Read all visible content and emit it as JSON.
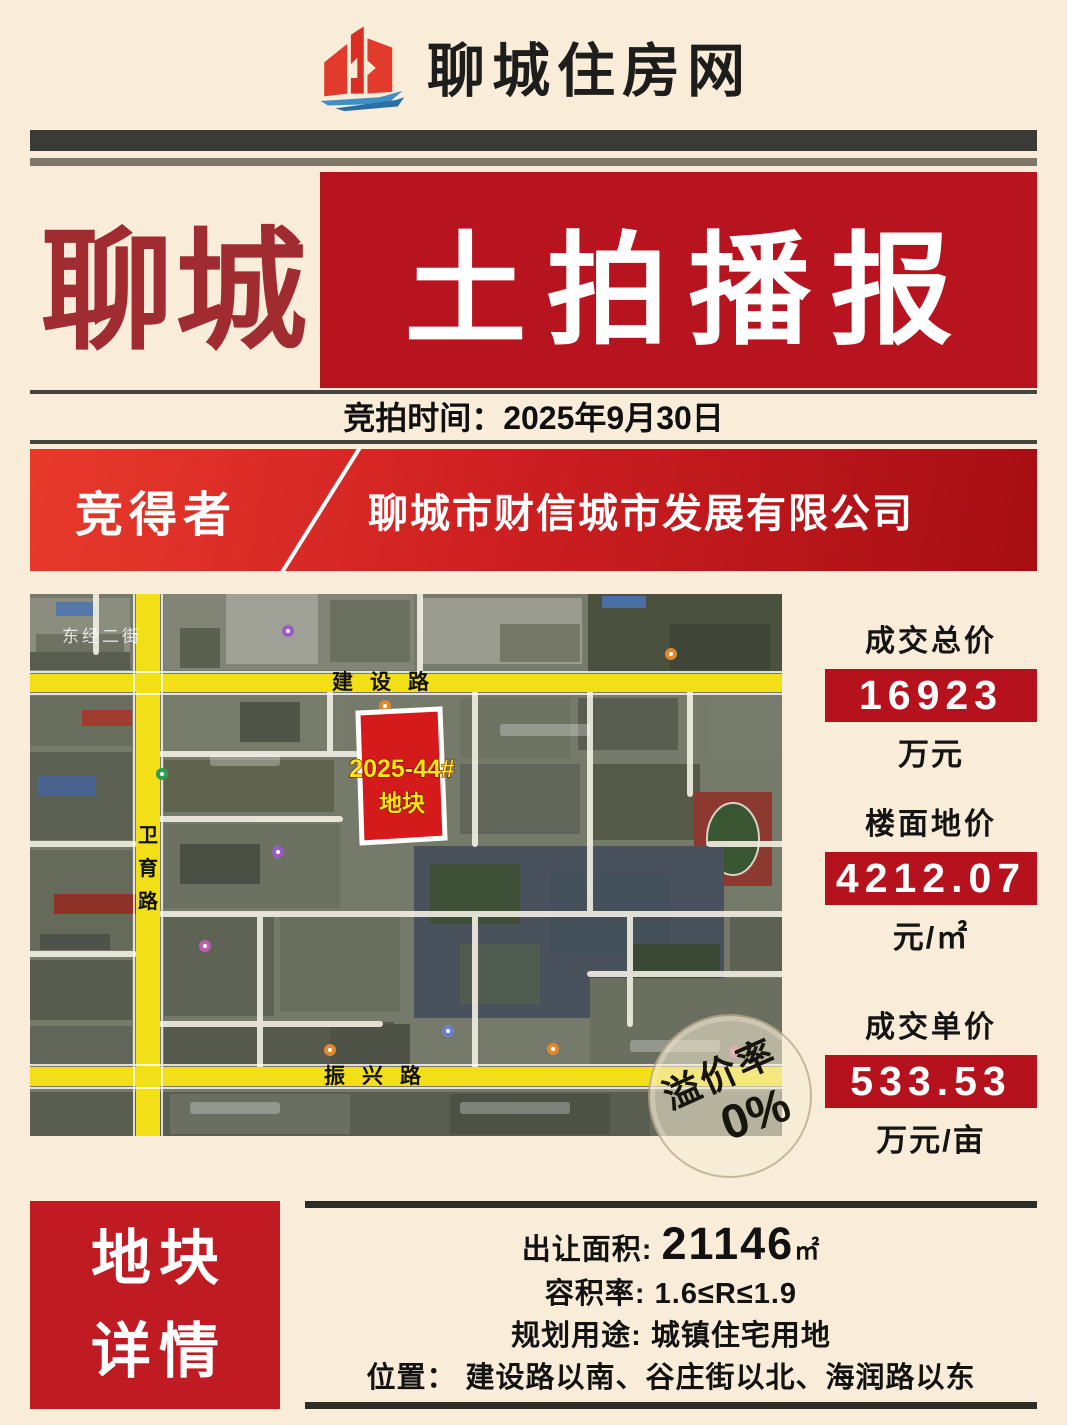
{
  "header": {
    "site_name": "聊城住房网"
  },
  "masthead": {
    "city": "聊城",
    "title": "土拍播报"
  },
  "auction_time": {
    "label": "竞拍时间：",
    "value": "2025年9月30日"
  },
  "winner": {
    "label": "竞得者",
    "company": "聊城市财信城市发展有限公司"
  },
  "map": {
    "road_north": "建设路",
    "road_west_chars": [
      "卫",
      "育",
      "路"
    ],
    "road_south": "振兴路",
    "district_label": "东经二街",
    "parcel": {
      "line1": "2025-44#",
      "line2": "地块"
    },
    "stamp": {
      "label": "溢价率",
      "value": "0%"
    }
  },
  "stats": [
    {
      "label": "成交总价",
      "value": "16923",
      "unit": "万元"
    },
    {
      "label": "楼面地价",
      "value": "4212.07",
      "unit": "元/㎡"
    },
    {
      "label": "成交单价",
      "value": "533.53",
      "unit": "万元/亩"
    }
  ],
  "details": {
    "panel_line1": "地块",
    "panel_line2": "详情",
    "area_label": "出让面积:",
    "area_value": "21146",
    "area_unit": "㎡",
    "far_label": "容积率:",
    "far_value": "1.6≤R≤1.9",
    "use_label": "规划用途:",
    "use_value": "城镇住宅用地",
    "loc_label": "位置：",
    "loc_value": "建设路以南、谷庄街以北、海润路以东"
  },
  "colors": {
    "cream_background": "#f9edda",
    "masthead_red_box": "#b8141f",
    "city_title_red": "#a02c31",
    "banner_red_left": "#e73a2b",
    "banner_red_right": "#a60e14",
    "stat_box_red": "#b6121d",
    "details_badge_red": "#c01b22",
    "dark_bar": "#3a3a36",
    "map_road_yellow": "#f3df17",
    "parcel_red": "#d51a1c",
    "parcel_label_yellow": "#ffe212"
  }
}
